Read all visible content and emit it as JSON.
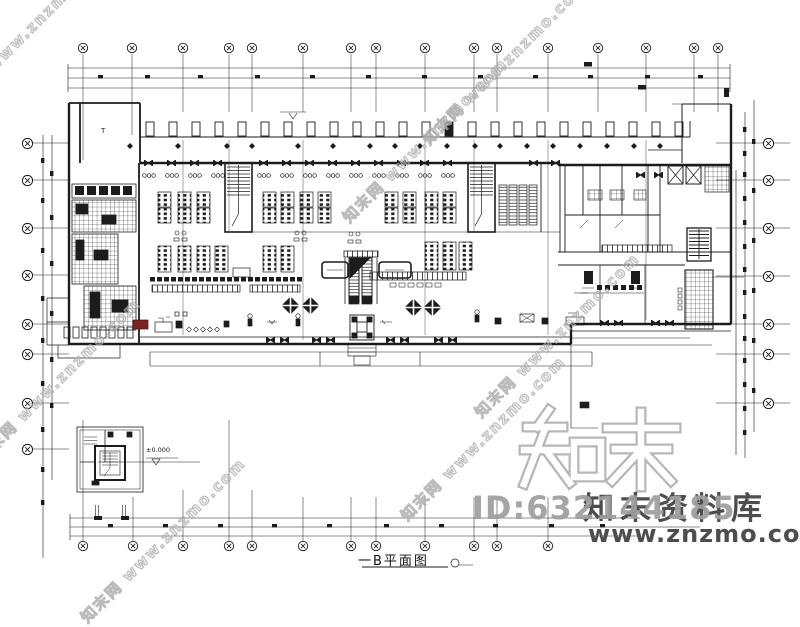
{
  "watermarks": {
    "tile_text": "知末网 www.znzmo.com",
    "brand_large": "知末",
    "brand_library": "知末资料库",
    "id_label": "ID:632144185",
    "site_url": "www.znzmo.com"
  },
  "plan": {
    "caption": "一B平面图",
    "elevation_label": "±0.000",
    "room_label": "T"
  },
  "colors": {
    "ink": "#1c1c1c",
    "accent_red": "#7a2323",
    "watermark_gray": "#9f9f9f",
    "watermark_dark": "#4d4d4d",
    "watermark_outline": "#b7b7b7"
  }
}
